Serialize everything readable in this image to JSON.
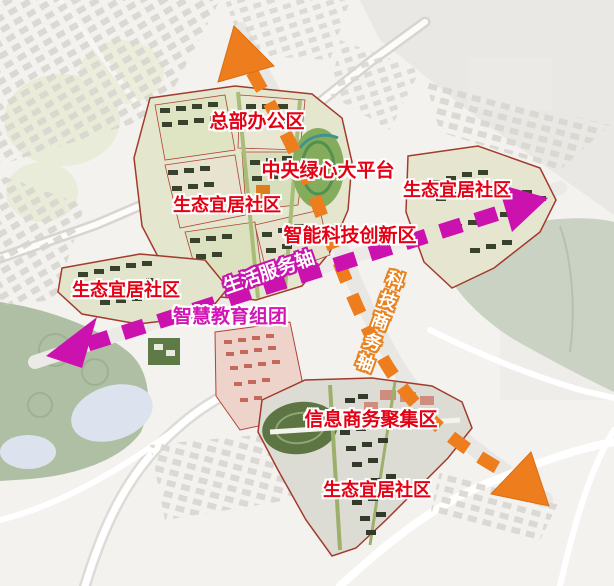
{
  "labels": {
    "hq_office": "总部办公区",
    "central_green_platform": "中央绿心大平台",
    "eco_community_upper_left": "生态宜居社区",
    "eco_community_right": "生态宜居社区",
    "smart_tech_innovation": "智能科技创新区",
    "life_service_axis": "生活服务轴",
    "eco_community_mid_left": "生态宜居社区",
    "smart_education_cluster": "智慧教育组团",
    "tech_business_axis": "科技商务轴",
    "info_business_district": "信息商务聚集区",
    "eco_community_bottom": "生态宜居社区"
  },
  "axes": {
    "life_service_axis": {
      "label": "生活服务轴",
      "style": "magenta dashed double-headed arrow",
      "color": "#c913ae",
      "orientation": "lower-left to upper-right"
    },
    "tech_business_axis": {
      "label": "科技商务轴",
      "style": "orange dashed double-headed arrow",
      "color": "#ee7d1e",
      "orientation": "top to lower-right"
    }
  },
  "colors": {
    "label_red": "#e60014",
    "label_magenta": "#d315b5",
    "axis_magenta": "#c913ae",
    "axis_orange": "#ee7d1e",
    "park_green": "#aebfa3",
    "lake_green": "#c9d2c3",
    "core_fill": "#e4e6ce",
    "boundary_red": "#a23b2c"
  }
}
